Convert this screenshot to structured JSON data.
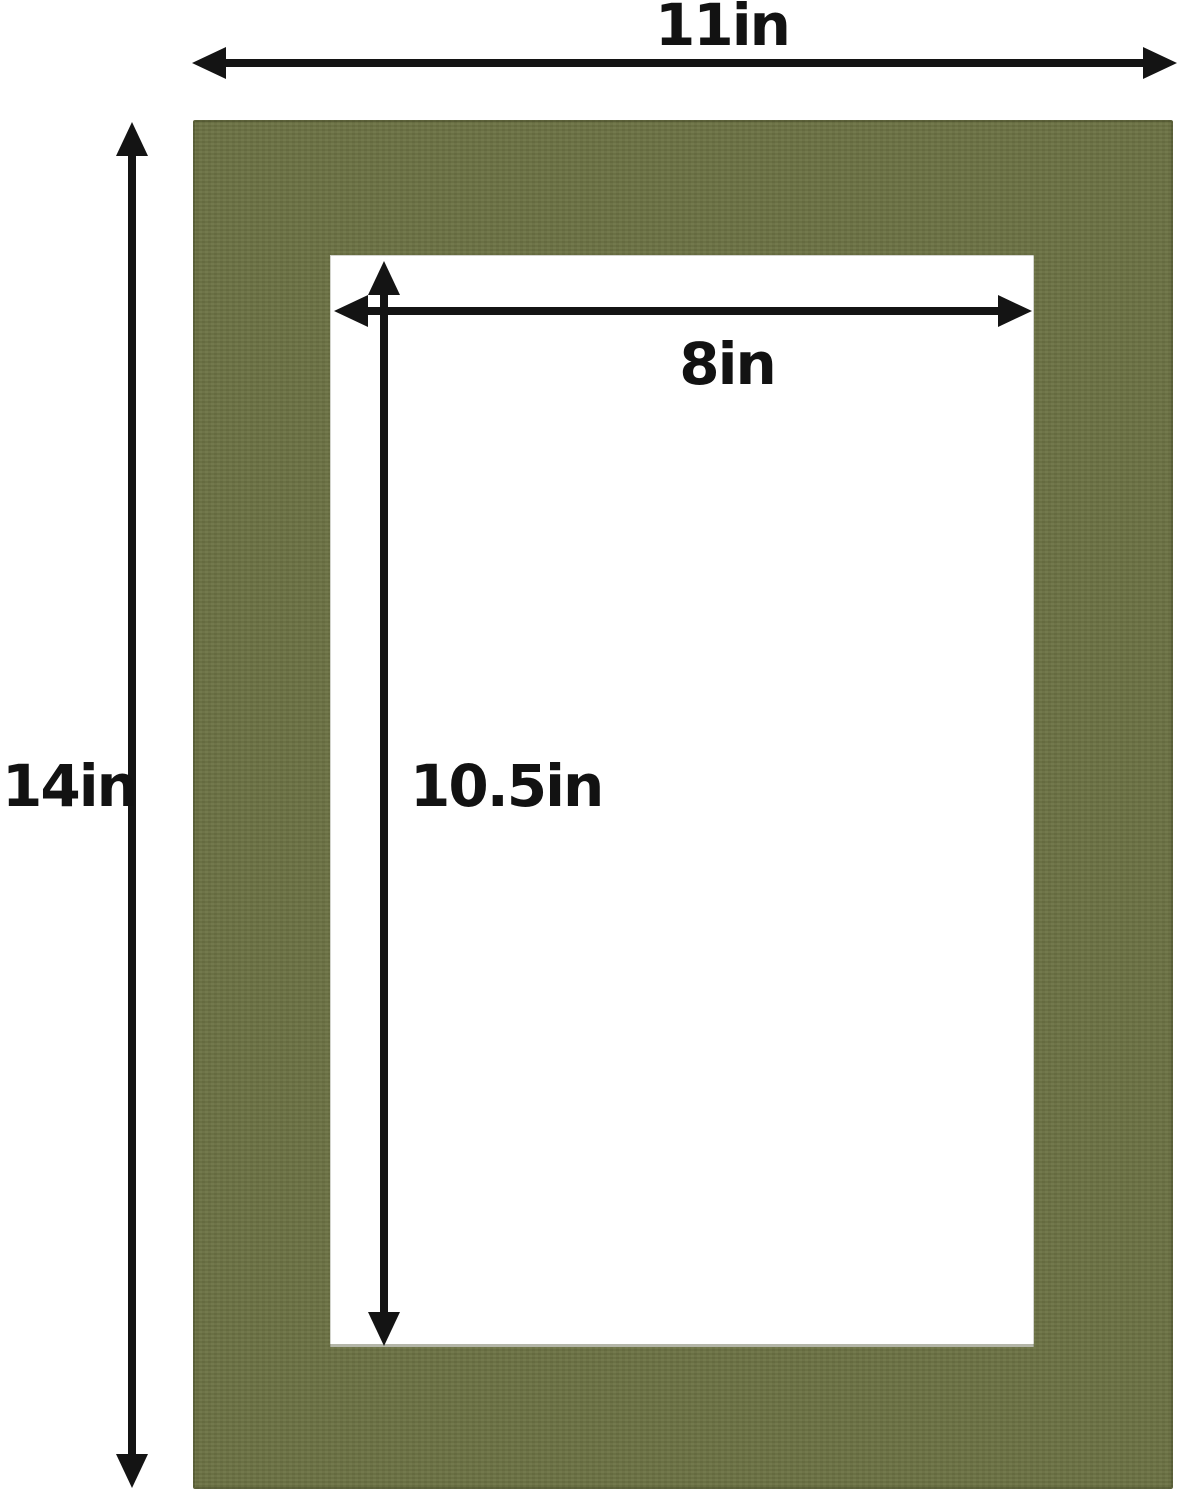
{
  "diagram": {
    "description": "Olive green picture frame mat board with cut opening and dimension arrows",
    "colors": {
      "mat": "#6b7143",
      "mat_edge": "#4e542e",
      "opening": "#ffffff",
      "dimension_line": "#141414",
      "background": "#ffffff",
      "label_text": "#121212"
    },
    "dimensions": {
      "outer_width_label": "11in",
      "outer_height_label": "14in",
      "opening_width_label": "8in",
      "opening_height_label": "10.5in"
    }
  }
}
